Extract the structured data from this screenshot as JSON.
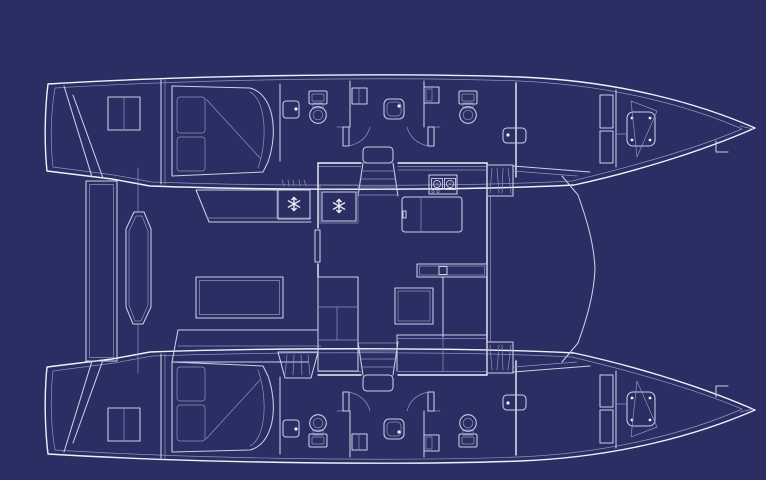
{
  "diagram": {
    "kind": "catamaran-yacht-deck-plan-blueprint",
    "orientation": "bows-pointing-right",
    "colors": {
      "background": "#2a2e62",
      "line": "#ccd0e6",
      "line_bright": "#f0f1f8",
      "line_dim": "#9094c0"
    },
    "icons": [
      {
        "name": "snowflake-icon",
        "meaning": "refrigerator / freezer box",
        "glyph": "six-spoke asterisk"
      },
      {
        "name": "burner-icon",
        "meaning": "galley stove burner",
        "glyph": "circle in square"
      },
      {
        "name": "toilet-icon",
        "meaning": "marine toilet",
        "glyph": "bowl circle with tank"
      },
      {
        "name": "sink-icon",
        "meaning": "washbasin",
        "glyph": "rounded square with faucet dot"
      },
      {
        "name": "stairs-icon",
        "meaning": "companionway steps",
        "glyph": "hatched treads"
      }
    ],
    "regions": [
      "port-hull-aft-cabin-with-double-berth",
      "port-hull-two-head-compartments",
      "port-hull-forward-cabin",
      "starboard-hull-aft-cabin-with-double-berth",
      "starboard-hull-two-head-compartments",
      "starboard-hull-forward-cabin",
      "saloon-with-galley-nav-desk-and-sofa",
      "aft-cockpit-with-benches-table-and-lounge",
      "transom-swim-platforms",
      "foredeck-and-trampoline-area"
    ]
  }
}
